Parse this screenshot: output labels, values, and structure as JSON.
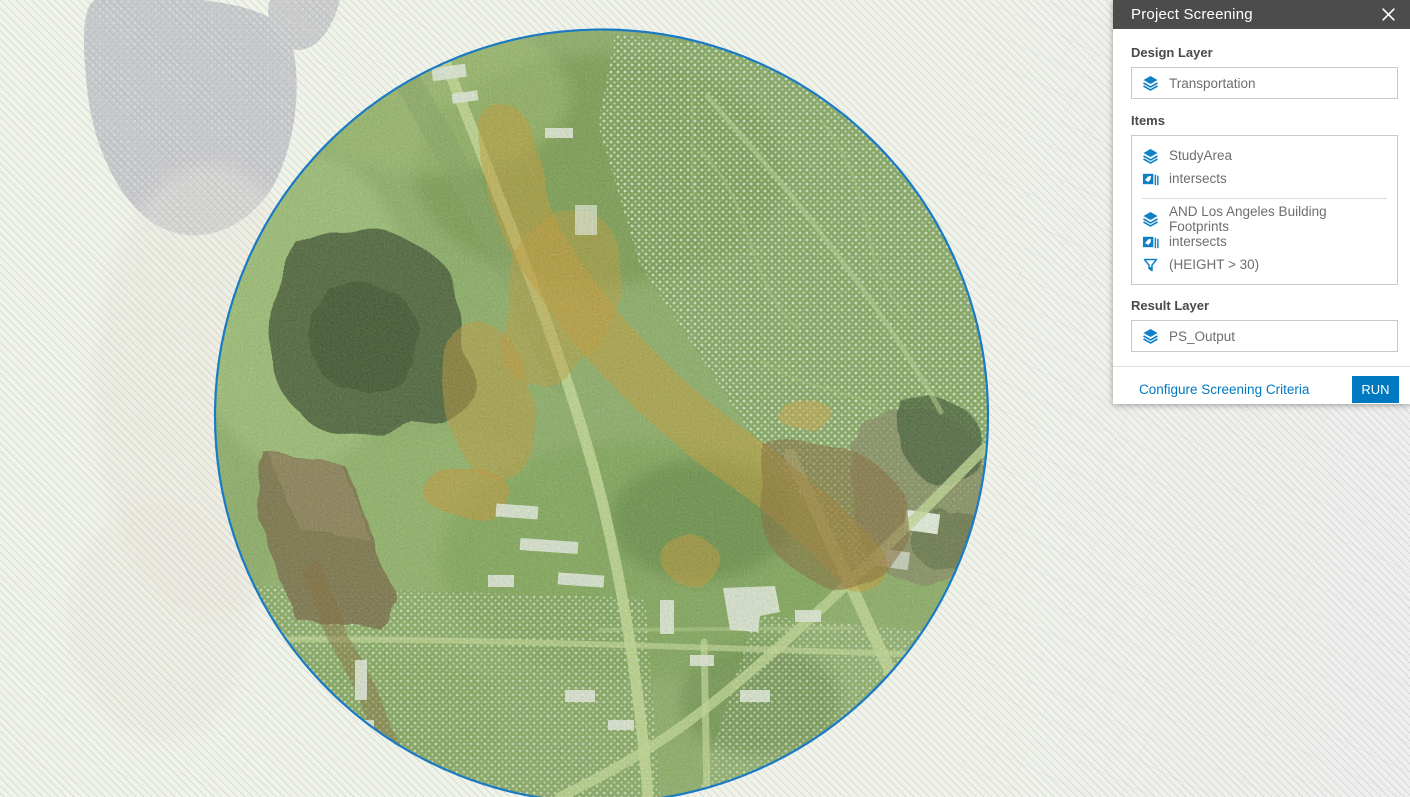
{
  "panel": {
    "title": "Project Screening",
    "design_layer": {
      "label": "Design Layer",
      "value": "Transportation",
      "icon": "layers-icon"
    },
    "items": {
      "label": "Items",
      "groups": [
        {
          "rows": [
            {
              "icon": "layers-icon",
              "text": "StudyArea"
            },
            {
              "icon": "intersects-icon",
              "text": "intersects"
            }
          ]
        },
        {
          "rows": [
            {
              "icon": "layers-icon",
              "text": "AND Los Angeles Building Footprints"
            },
            {
              "icon": "intersects-icon",
              "text": "intersects"
            },
            {
              "icon": "filter-icon",
              "text": "(HEIGHT > 30)"
            }
          ]
        }
      ]
    },
    "result_layer": {
      "label": "Result Layer",
      "value": "PS_Output",
      "icon": "layers-icon"
    },
    "footer": {
      "link_label": "Configure Screening Criteria",
      "run_label": "RUN"
    }
  },
  "colors": {
    "accent_blue": "#0079c1",
    "icon_blue": "#0e81c6",
    "header_gray": "#4c4c4c",
    "circle_outline": "#1a7ac4",
    "screening_orange": "#d29a35"
  }
}
